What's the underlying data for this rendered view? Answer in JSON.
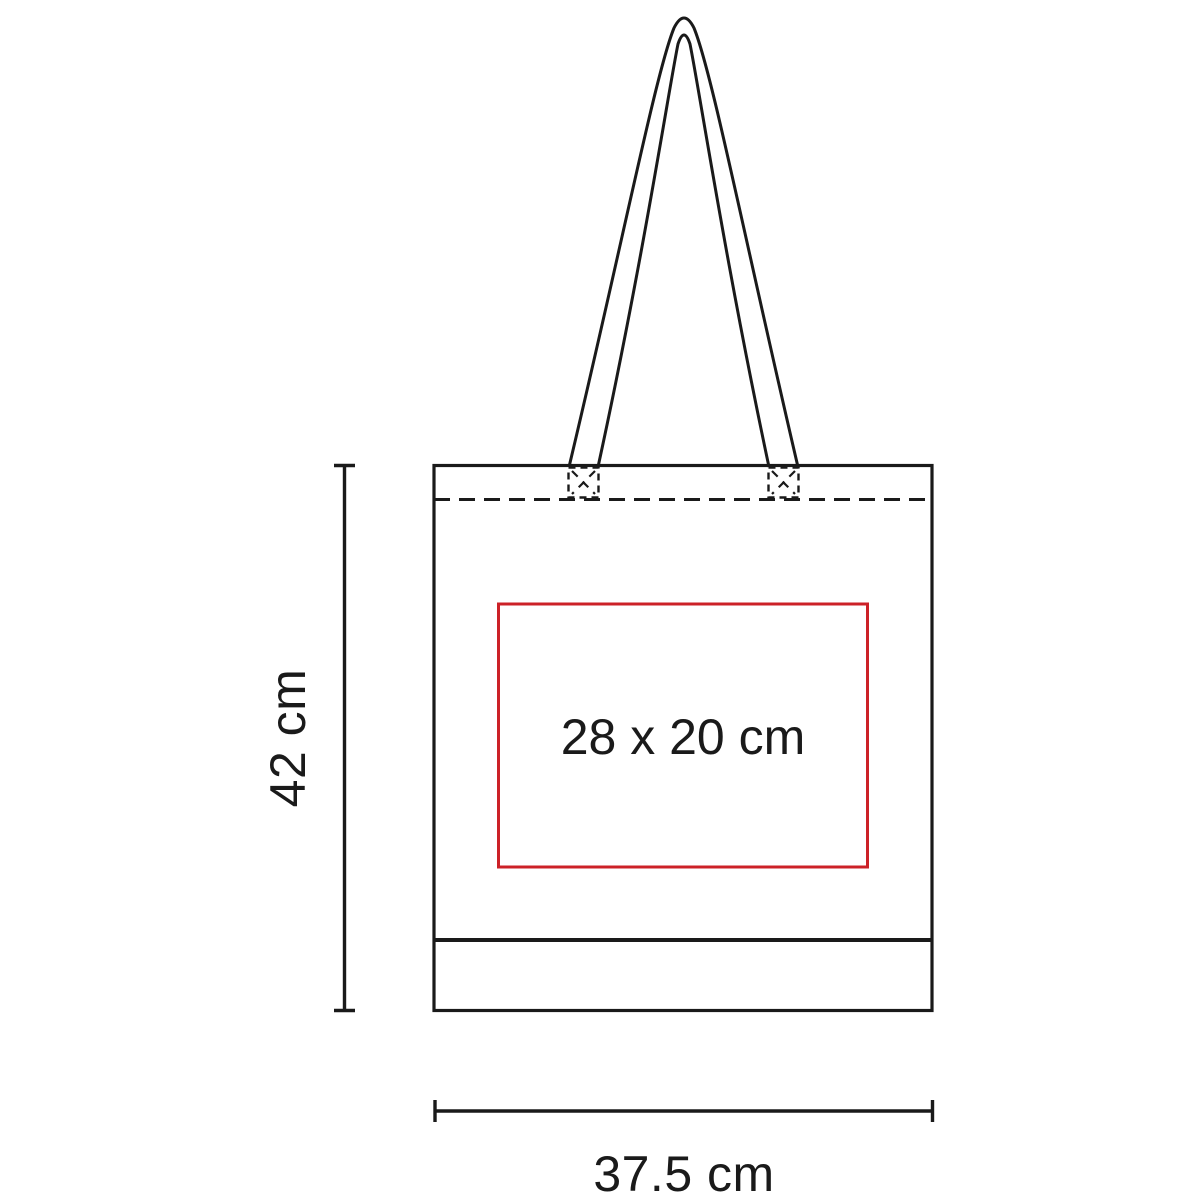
{
  "diagram": {
    "kind": "tote-bag-print-area-dimension-diagram",
    "height_label": "42 cm",
    "width_label": "37.5 cm",
    "print_area_label": "28 x 20 cm",
    "colors": {
      "line": "#1a1a1a",
      "print_area_border": "#cc2127",
      "background": "#ffffff"
    }
  }
}
